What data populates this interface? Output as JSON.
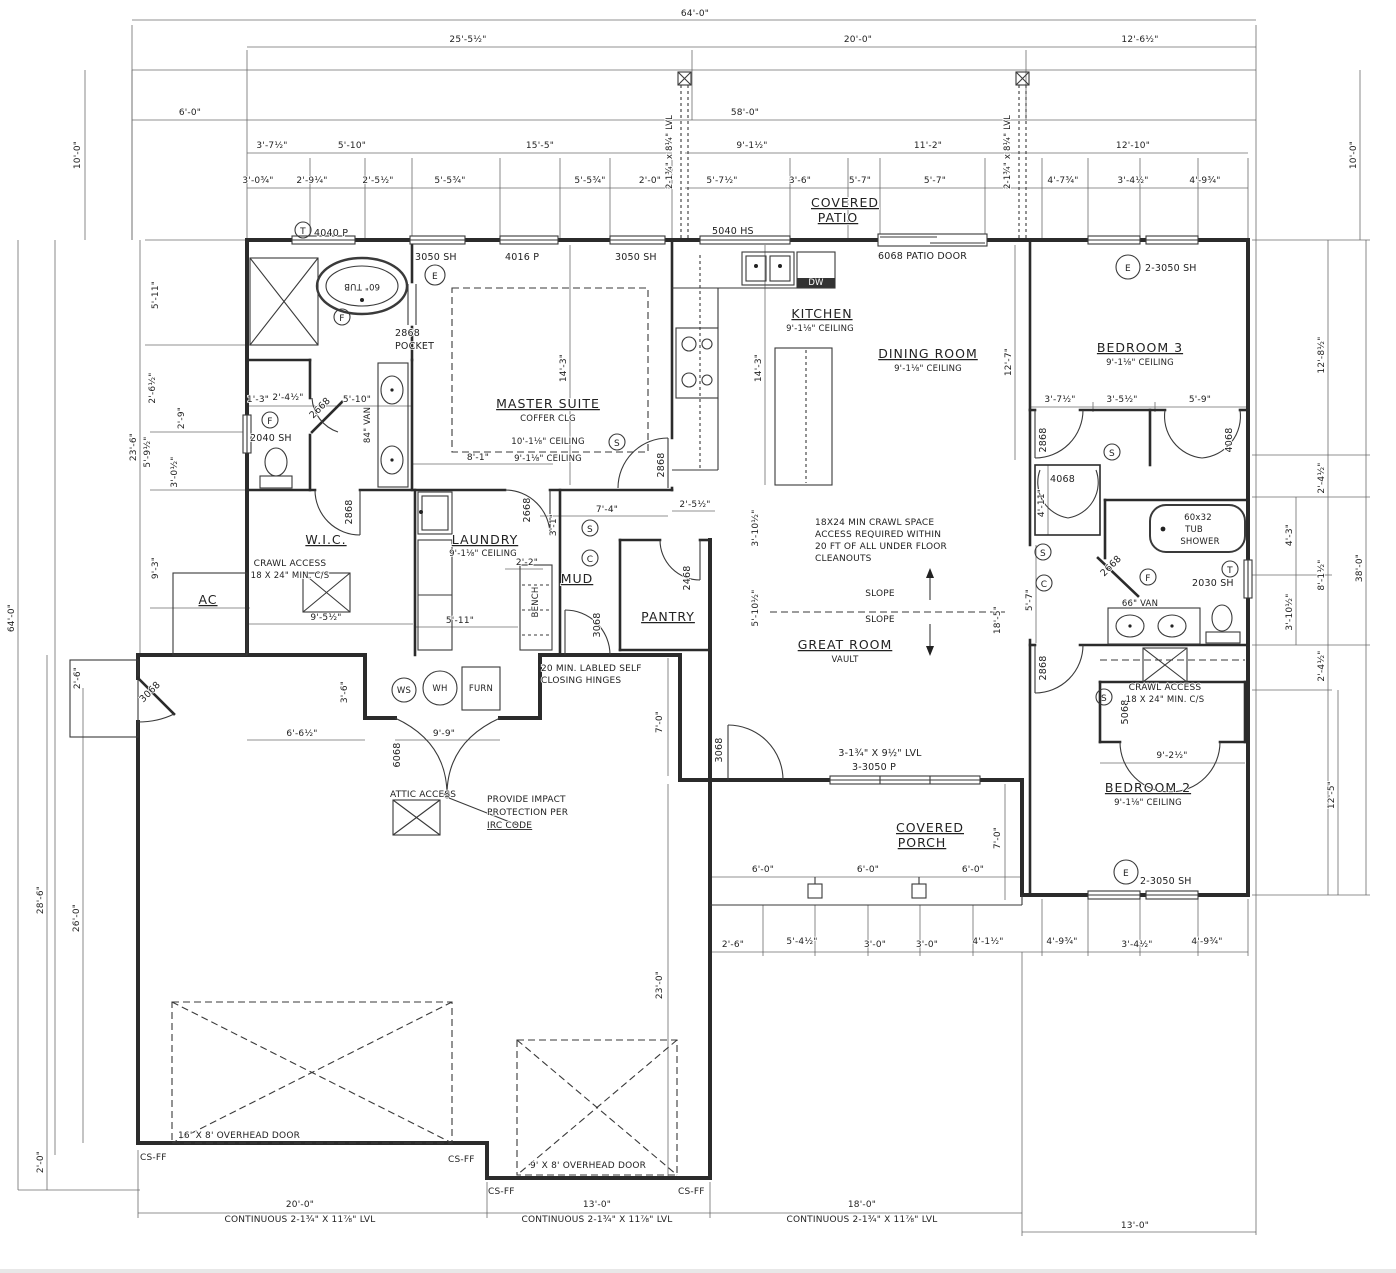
{
  "palette": {
    "paper": "#ffffff",
    "ink": "#2b2b2b",
    "dimline": "#6b6b6b"
  },
  "dims": {
    "top": [
      "64'-0\"",
      "25'-5½\"",
      "20'-0\"",
      "12'-6½\"",
      "6'-0\"",
      "58'-0\"",
      "3'-7½\"",
      "5'-10\"",
      "15'-5\"",
      "9'-1½\"",
      "11'-2\"",
      "12'-10\"",
      "3'-0¾\"",
      "2'-9¼\"",
      "2'-5½\"",
      "5'-5¾\"",
      "5'-5¾\"",
      "2'-0\"",
      "5'-7½\"",
      "3'-6\"",
      "5'-7\"",
      "5'-7\"",
      "4'-7¾\"",
      "3'-4½\"",
      "4'-9¾\""
    ],
    "left": [
      "10'-0\"",
      "64'-0\"",
      "23'-6\"",
      "5'-11\"",
      "2'-6½\"",
      "2'-9\"",
      "5'-9½\"",
      "3'-0½\"",
      "9'-3\"",
      "2'-6\"",
      "28'-6\"",
      "26'-0\"",
      "2'-0\""
    ],
    "right": [
      "10'-0\"",
      "12'-8½\"",
      "2'-4½\"",
      "4'-3\"",
      "8'-1½\"",
      "3'-10½\"",
      "2'-4½\"",
      "38'-0\"",
      "12'-5\""
    ],
    "bottom": [
      "2'-6\"",
      "5'-4½\"",
      "3'-0\"",
      "3'-0\"",
      "4'-1½\"",
      "4'-9¾\"",
      "3'-4½\"",
      "4'-9¾\"",
      "20'-0\"",
      "13'-0\"",
      "18'-0\"",
      "13'-0\""
    ],
    "lvl_note": "CONTINUOUS 2-1¾\" X 11⅞\" LVL",
    "inner": {
      "m143": "14'-3\"",
      "d127": "12'-7\"",
      "h81": "8'-1\"",
      "v510": "5'-10\"",
      "wc13": "1'-3\"",
      "wc24": "2'-4½\"",
      "h74": "7'-4\"",
      "h255": "2'-5½\"",
      "g310": "3'-10½\"",
      "g510": "5'-10½\"",
      "g185": "18'-5\"",
      "wic95": "9'-5½\"",
      "l511": "5'-11\"",
      "b22": "2'-2\"",
      "m66": "6'-6½\"",
      "m36": "3'-6\"",
      "m99": "9'-9\"",
      "g70": "7'-0\"",
      "g230": "23'-0\"",
      "p70": "7'-0\"",
      "p60": "6'-0\"",
      "b3a": "3'-7½\"",
      "b3b": "3'-5½\"",
      "b3c": "5'-9\"",
      "hc411": "4'-11\"",
      "h57": "5'-7\"",
      "c92": "9'-2½\"",
      "s31": "3'-1\""
    }
  },
  "rooms": {
    "master": {
      "name": "MASTER SUITE",
      "sub": "COFFER CLG",
      "ceil1": "10'-1⅛\" CEILING"
    },
    "ceil9": "9'-1⅛\" CEILING",
    "kitchen": "KITCHEN",
    "dining": "DINING ROOM",
    "great": {
      "name": "GREAT ROOM",
      "sub": "VAULT"
    },
    "bed3": "BEDROOM 3",
    "bed2": "BEDROOM 2",
    "wic": "W.I.C.",
    "laundry": "LAUNDRY",
    "mud": "MUD",
    "pantry": "PANTRY",
    "patio": {
      "l1": "COVERED",
      "l2": "PATIO"
    },
    "porch": {
      "l1": "COVERED",
      "l2": "PORCH"
    },
    "ac": "AC"
  },
  "openings": {
    "t4040": "4040 P",
    "w3050": "3050 SH",
    "w4016": "4016 P",
    "w5040": "5040 HS",
    "patio_door": "6068 PATIO DOOR",
    "w23050": "2-3050 SH",
    "w2040": "2040 SH",
    "w2030": "2030 SH",
    "d2868": "2868",
    "pocket_l1": "2868",
    "pocket_l2": "POCKET",
    "d2668": "2668",
    "d2468": "2468",
    "d3068": "3068",
    "d4068": "4068",
    "d5068": "5068",
    "d6068": "6068",
    "w33050": "3-3050 P",
    "hdr_lvl": "3-1¾\" X 9½\" LVL",
    "post_lvl": "2-1¾\" x 8¼\" LVL"
  },
  "fixtures": {
    "tub": "60\" TUB",
    "van84": "84\" VAN",
    "van66": "66\" VAN",
    "tub2_l1": "60x32",
    "tub2_l2": "TUB",
    "tub2_l3": "SHOWER",
    "dw": "DW",
    "ws": "WS",
    "wh": "WH",
    "furn": "FURN",
    "bench": "BENCH"
  },
  "notes": {
    "crawl_l1": "18X24 MIN CRAWL SPACE",
    "crawl_l2": "ACCESS REQUIRED WITHIN",
    "crawl_l3": "20 FT OF ALL UNDER FLOOR",
    "crawl_l4": "CLEANOUTS",
    "hinge_l1": "20 MIN. LABLED SELF",
    "hinge_l2": "CLOSING HINGES",
    "impact_l1": "PROVIDE IMPACT",
    "impact_l2": "PROTECTION PER",
    "impact_l3": "IRC CODE",
    "attic": "ATTIC ACCESS",
    "ca_l1": "CRAWL ACCESS",
    "ca_l2": "18 X 24\" MIN. C/S",
    "ohd16": "16' X 8' OVERHEAD DOOR",
    "ohd9": "9' X 8' OVERHEAD DOOR",
    "csff": "CS-FF",
    "slope": "SLOPE"
  },
  "symbols": {
    "e": "E",
    "t": "T",
    "f": "F",
    "s": "S",
    "c": "C"
  }
}
